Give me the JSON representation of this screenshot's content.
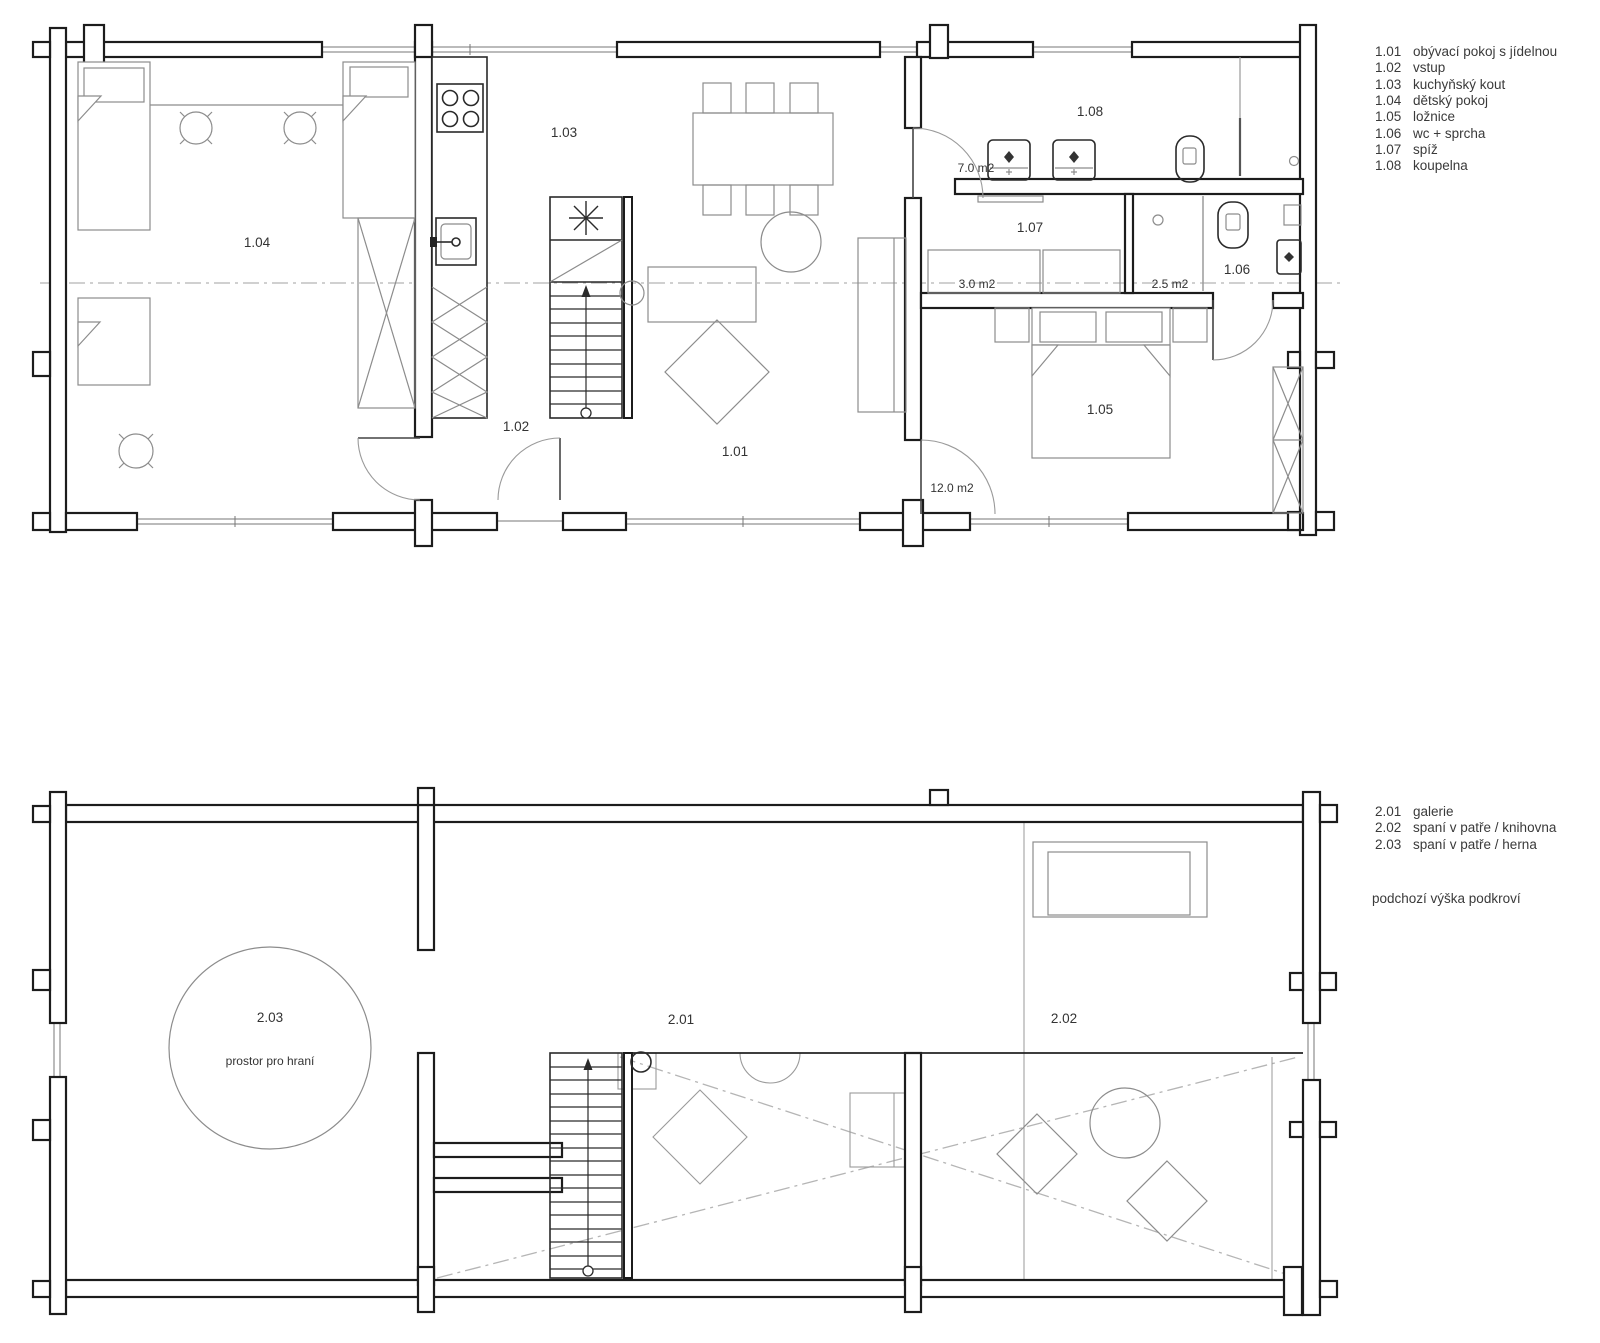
{
  "floor1": {
    "legend": [
      {
        "code": "1.01",
        "label": "obývací pokoj s jídelnou"
      },
      {
        "code": "1.02",
        "label": "vstup"
      },
      {
        "code": "1.03",
        "label": "kuchyňský kout"
      },
      {
        "code": "1.04",
        "label": "dětský pokoj"
      },
      {
        "code": "1.05",
        "label": "ložnice"
      },
      {
        "code": "1.06",
        "label": "wc + sprcha"
      },
      {
        "code": "1.07",
        "label": "spíž"
      },
      {
        "code": "1.08",
        "label": "koupelna"
      }
    ],
    "areas": {
      "koupelna": "7.0 m2",
      "spiz": "3.0 m2",
      "sprcha": "2.5 m2",
      "loznice": "12.0 m2"
    }
  },
  "floor2": {
    "legend": [
      {
        "code": "2.01",
        "label": "galerie"
      },
      {
        "code": "2.02",
        "label": "spaní v patře / knihovna"
      },
      {
        "code": "2.03",
        "label": "spaní v patře / herna"
      }
    ],
    "note": "podchozí výška podkroví",
    "play_area": "prostor pro hraní"
  },
  "colors": {
    "ink": "#1c1c1c",
    "furniture": "#8c8c8c",
    "centerline": "#b5b5b5",
    "text": "#333333"
  }
}
